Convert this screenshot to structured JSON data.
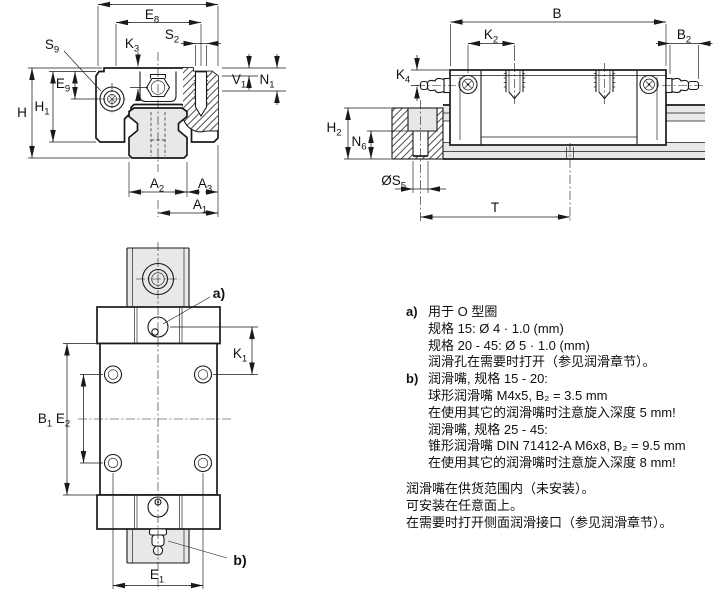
{
  "colors": {
    "line": "#1a1a1a",
    "gray": "#e8e8e8",
    "text": "#111111",
    "bg": "#ffffff"
  },
  "dims": {
    "front": {
      "e8": {
        "base": "E",
        "sub": "8"
      },
      "s2": {
        "base": "S",
        "sub": "2"
      },
      "s9": {
        "base": "S",
        "sub": "9"
      },
      "k3": {
        "base": "K",
        "sub": "3"
      },
      "v1": {
        "base": "V",
        "sub": "1"
      },
      "n1": {
        "base": "N",
        "sub": "1"
      },
      "e9": {
        "base": "E",
        "sub": "9"
      },
      "h1": {
        "base": "H",
        "sub": "1"
      },
      "h": {
        "base": "H",
        "sub": ""
      },
      "a2": {
        "base": "A",
        "sub": "2"
      },
      "a3": {
        "base": "A",
        "sub": "3"
      },
      "a1": {
        "base": "A",
        "sub": "1"
      }
    },
    "side": {
      "b": {
        "base": "B",
        "sub": ""
      },
      "k2": {
        "base": "K",
        "sub": "2"
      },
      "b2": {
        "base": "B",
        "sub": "2"
      },
      "k4": {
        "base": "K",
        "sub": "4"
      },
      "h2": {
        "base": "H",
        "sub": "2"
      },
      "n6": {
        "base": "N",
        "sub": "6"
      },
      "s5": {
        "base": "ØS",
        "sub": "5"
      },
      "t": {
        "base": "T",
        "sub": ""
      }
    },
    "plan": {
      "k1": {
        "base": "K",
        "sub": "1"
      },
      "b1": {
        "base": "B",
        "sub": "1"
      },
      "e2": {
        "base": "E",
        "sub": "2"
      },
      "e1": {
        "base": "E",
        "sub": "1"
      }
    }
  },
  "callouts": {
    "a": "a)",
    "b": "b)"
  },
  "notes": {
    "items": [
      {
        "label": "a)",
        "lines": [
          "用于 O 型圈",
          "规格 15: Ø 4 · 1.0 (mm)",
          "规格 20 - 45: Ø 5 · 1.0 (mm)",
          "润滑孔在需要时打开（参见润滑章节）。"
        ]
      },
      {
        "label": "b)",
        "lines": [
          "润滑嘴, 规格 15 - 20:",
          "球形润滑嘴 M4x5, B₂ = 3.5 mm",
          "在使用其它的润滑嘴时注意旋入深度 5 mm!",
          "润滑嘴, 规格 25 - 45:",
          "锥形润滑嘴 DIN 71412-A M6x8, B₂ = 9.5 mm",
          "在使用其它的润滑嘴时注意旋入深度 8 mm!"
        ]
      }
    ],
    "footer": [
      "润滑嘴在供货范围内（未安装）。",
      "可安装在任意面上。",
      "在需要时打开侧面润滑接口（参见润滑章节）。"
    ]
  }
}
